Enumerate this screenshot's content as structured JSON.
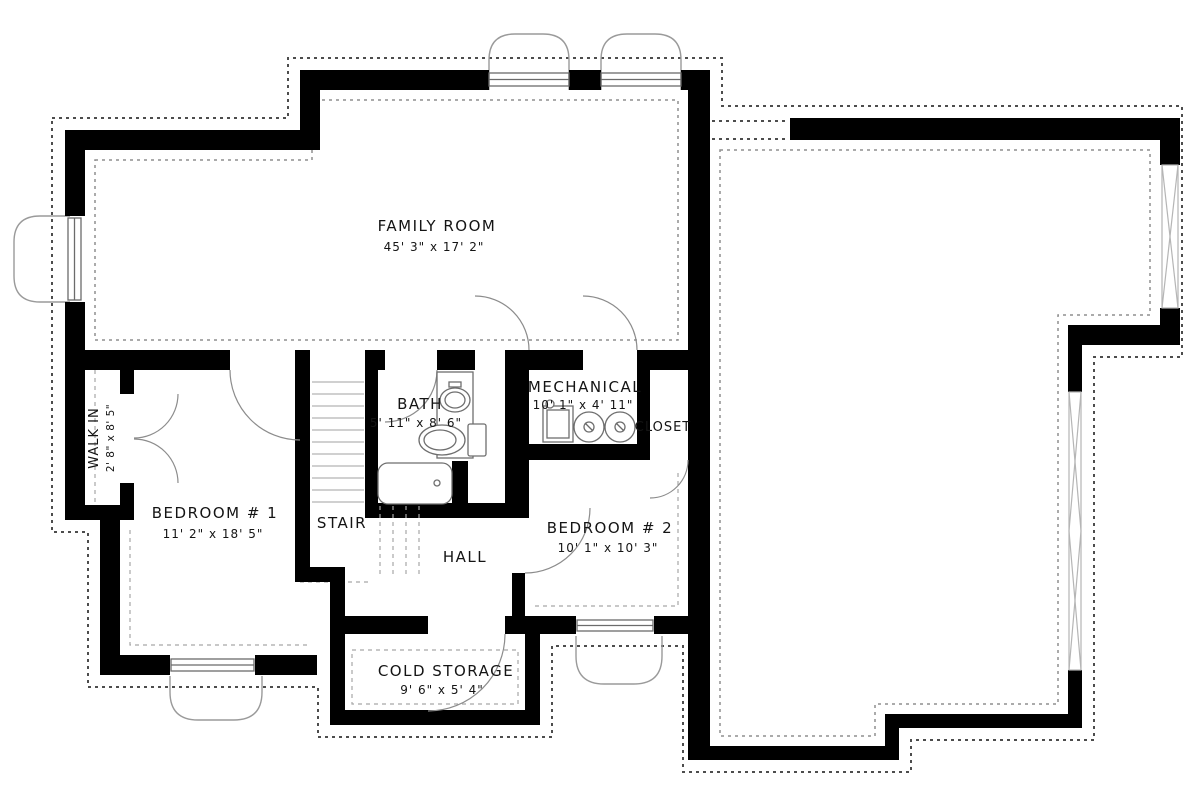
{
  "rooms": [
    {
      "id": "family_room",
      "name": "FAMILY ROOM",
      "dims": "45' 3\" x 17' 2\""
    },
    {
      "id": "walk_in",
      "name": "WALK IN",
      "dims": "2' 8\" x 8' 5\""
    },
    {
      "id": "bedroom_1",
      "name": "BEDROOM # 1",
      "dims": "11' 2\" x 18' 5\""
    },
    {
      "id": "stair",
      "name": "STAIR",
      "dims": ""
    },
    {
      "id": "bath",
      "name": "BATH",
      "dims": "5' 11\" x 8' 6\""
    },
    {
      "id": "hall",
      "name": "HALL",
      "dims": ""
    },
    {
      "id": "mechanical",
      "name": "MECHANICAL",
      "dims": "10' 1\" x 4' 11\""
    },
    {
      "id": "closet",
      "name": "CLOSET",
      "dims": ""
    },
    {
      "id": "bedroom_2",
      "name": "BEDROOM # 2",
      "dims": "10' 1\" x 10' 3\""
    },
    {
      "id": "cold_storage",
      "name": "COLD STORAGE",
      "dims": "9' 6\" x 5' 4\""
    }
  ],
  "colors": {
    "wall": "#000000",
    "background": "#ffffff",
    "line": "#6b6b6b",
    "dash": "#4d4d4d",
    "light": "#9a9a9a",
    "text": "#141414"
  }
}
